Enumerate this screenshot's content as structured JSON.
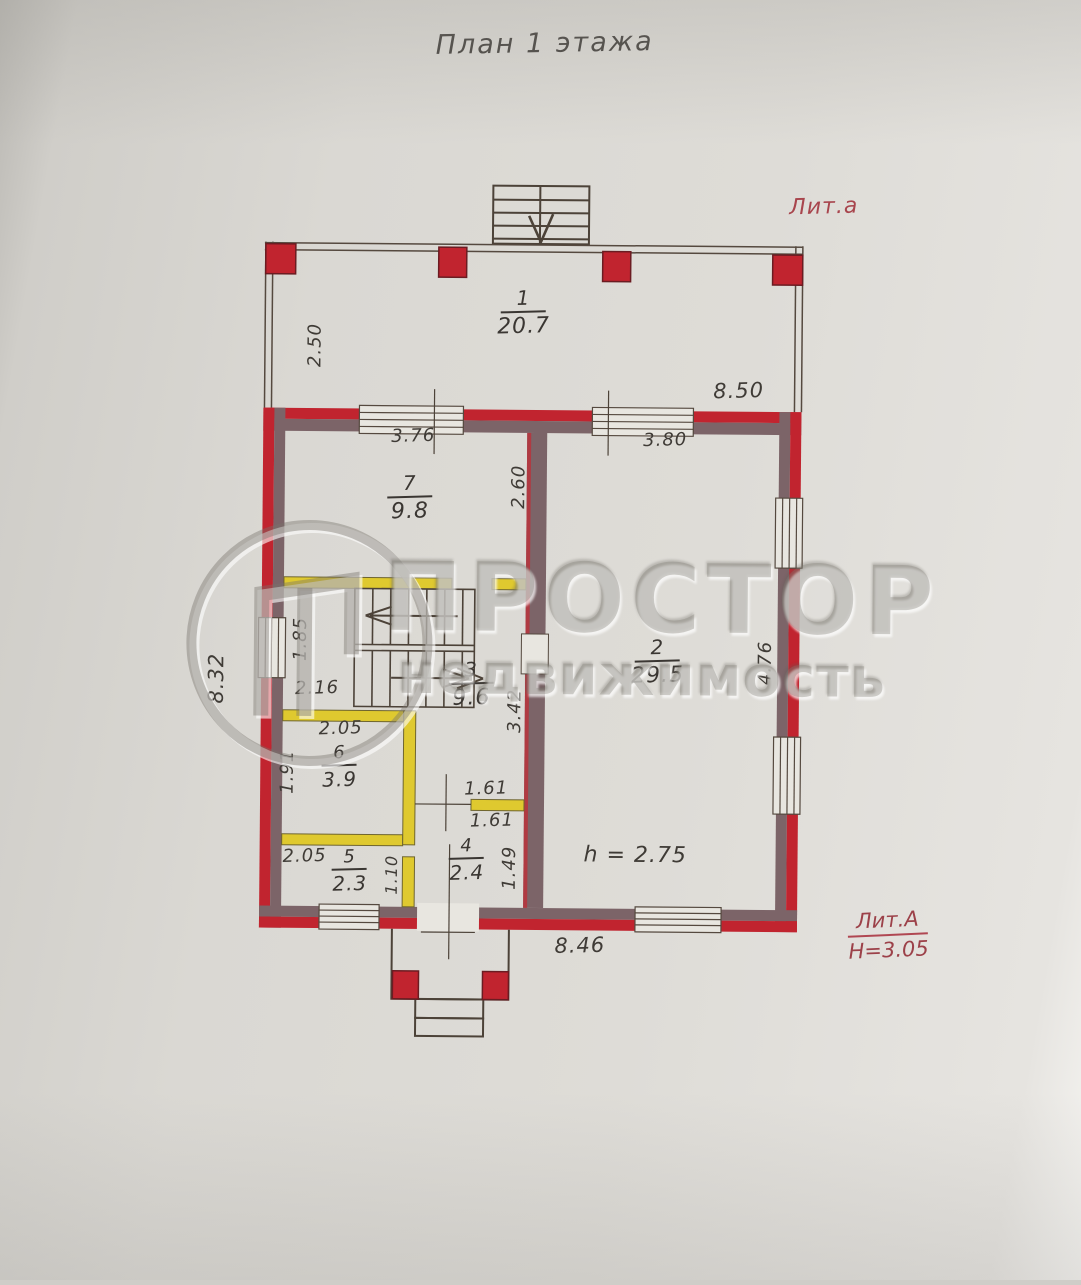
{
  "title": "План 1 этажа",
  "litera_top": "Лит.а",
  "litera_bottom": {
    "name": "Лит.А",
    "height": "Н=3.05"
  },
  "ceiling_note": "h = 2.75",
  "watermark": {
    "line1": "ПРОСТОР",
    "line2": "недвижимость"
  },
  "rooms": {
    "r1": {
      "number": "1",
      "area": "20.7"
    },
    "r2": {
      "number": "2",
      "area": "29.5"
    },
    "r3": {
      "number": "3",
      "area": "9.6"
    },
    "r4": {
      "number": "4",
      "area": "2.4"
    },
    "r5": {
      "number": "5",
      "area": "2.3"
    },
    "r6": {
      "number": "6",
      "area": "3.9"
    },
    "r7": {
      "number": "7",
      "area": "9.8"
    }
  },
  "dimensions": {
    "veranda_height": "2.50",
    "veranda_width": "8.50",
    "window_left": "3.76",
    "window_right": "3.80",
    "room7_side": "2.60",
    "left_wall": "8.32",
    "stair_width": "1.85",
    "stair_run": "2.16",
    "room3_side": "3.42",
    "right_wall_pier": "4.76",
    "room6_width": "2.05",
    "room6_depth": "1.91",
    "opening_top": "1.61",
    "opening_bottom": "1.61",
    "room5_width": "2.05",
    "room5_depth": "1.10",
    "room4_depth": "1.49",
    "bottom_wall": "8.46"
  },
  "colors": {
    "wall_red": "#c1242f",
    "wall_inner": "#7c6468",
    "partition_yellow": "#dfc92f",
    "ink": "#3f3b36",
    "red_text": "#a8454d",
    "paper": "#dcdad5"
  }
}
